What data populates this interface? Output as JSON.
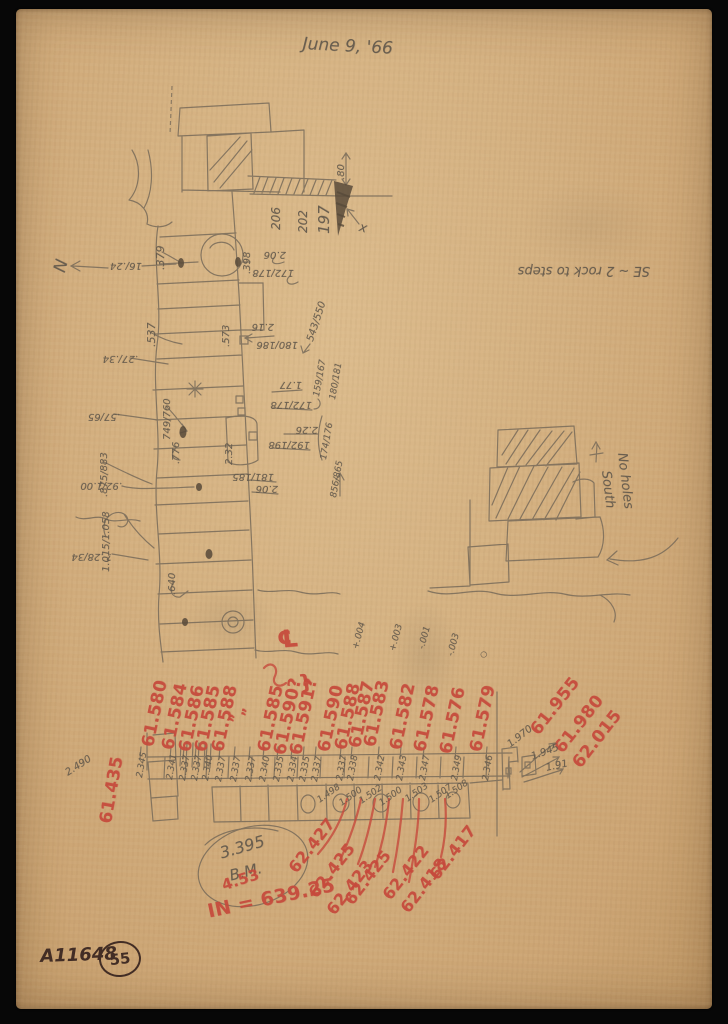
{
  "sheet": {
    "date": "June 9, '66",
    "catalog_number": "A11648",
    "sheet_number": "55"
  },
  "colors": {
    "paper": "#d4b080",
    "pencil": "#63594c",
    "red_crayon": "#c64a3c",
    "ink": "#422d25",
    "background": "#070707"
  },
  "annotations": {
    "plan_measurements": [
      {
        "t": ".379",
        "x": 155,
        "y": 270,
        "r": -90,
        "s": 11
      },
      {
        "t": "16/.24",
        "x": 142,
        "y": 270,
        "r": 180
      },
      {
        "t": ".537",
        "x": 146,
        "y": 347,
        "r": -90,
        "s": 11
      },
      {
        "t": ".27/.34",
        "x": 138,
        "y": 363,
        "r": 180
      },
      {
        "t": ".57/65",
        "x": 120,
        "y": 421,
        "r": 180
      },
      {
        "t": "749/760",
        "x": 163,
        "y": 440,
        "r": -90
      },
      {
        "t": ".776",
        "x": 172,
        "y": 464,
        "r": -90
      },
      {
        "t": ".875/883",
        "x": 100,
        "y": 497,
        "r": -90
      },
      {
        "t": ".92/1.00",
        "x": 122,
        "y": 490,
        "r": 180
      },
      {
        "t": "1.015/1.058",
        "x": 102,
        "y": 572,
        "r": -90
      },
      {
        "t": "? .28/34",
        "x": 112,
        "y": 561,
        "r": 180
      },
      {
        "t": ".640",
        "x": 168,
        "y": 595,
        "r": -90
      },
      {
        "t": ".398",
        "x": 243,
        "y": 274,
        "r": -90
      },
      {
        "t": "2.06",
        "x": 286,
        "y": 259,
        "r": 180
      },
      {
        "t": "172/178",
        "x": 294,
        "y": 277,
        "r": 180
      },
      {
        "t": "2.16",
        "x": 274,
        "y": 331,
        "r": 180
      },
      {
        "t": "180/186",
        "x": 298,
        "y": 349,
        "r": 180
      },
      {
        "t": "543/550",
        "x": 306,
        "y": 340,
        "r": -72
      },
      {
        "t": ".573",
        "x": 222,
        "y": 347,
        "r": -90
      },
      {
        "t": "1.77",
        "x": 302,
        "y": 389,
        "r": 180
      },
      {
        "t": "159/167",
        "x": 313,
        "y": 396,
        "r": -80,
        "s": 9
      },
      {
        "t": "180/181",
        "x": 329,
        "y": 399,
        "r": -80,
        "s": 9
      },
      {
        "t": "172/178",
        "x": 312,
        "y": 409,
        "r": 180
      },
      {
        "t": "174/176",
        "x": 320,
        "y": 459,
        "r": -80,
        "s": 9
      },
      {
        "t": "2.26",
        "x": 318,
        "y": 434,
        "r": 180
      },
      {
        "t": "192/198",
        "x": 310,
        "y": 449,
        "r": 180
      },
      {
        "t": "2.32",
        "x": 225,
        "y": 465,
        "r": -90
      },
      {
        "t": "181/185",
        "x": 274,
        "y": 481,
        "r": 180
      },
      {
        "t": "2.06",
        "x": 278,
        "y": 493,
        "r": 180
      },
      {
        "t": "856/865",
        "x": 330,
        "y": 497,
        "r": -80,
        "s": 9
      },
      {
        "t": "206",
        "x": 270,
        "y": 230,
        "r": -90,
        "s": 12
      },
      {
        "t": "202",
        "x": 297,
        "y": 233,
        "r": -90,
        "s": 12
      },
      {
        "t": "197",
        "x": 317,
        "y": 234,
        "r": -90,
        "s": 15
      },
      {
        "t": ".80",
        "x": 337,
        "y": 180,
        "r": -90
      },
      {
        "t": "x",
        "x": 361,
        "y": 221,
        "r": 15,
        "s": 13,
        "n": "x-mark"
      }
    ],
    "notes": [
      {
        "t": "SE ~ 2 rock to steps",
        "x": 650,
        "y": 277,
        "r": 180,
        "n": "note-rock-to-steps"
      },
      {
        "t": "N",
        "x": 52,
        "y": 270,
        "r": -75,
        "s": 17,
        "n": "north-label"
      },
      {
        "t": "No holes",
        "x": 628,
        "y": 452,
        "r": 83,
        "n": "note-no-holes"
      },
      {
        "t": "South",
        "x": 612,
        "y": 470,
        "r": 83,
        "n": "note-south"
      }
    ],
    "red_elevations": [
      {
        "t": "61.580",
        "x": 140,
        "y": 745
      },
      {
        "t": "61.584",
        "x": 160,
        "y": 748
      },
      {
        "t": "61.586",
        "x": 177,
        "y": 750
      },
      {
        "t": "61.585",
        "x": 193,
        "y": 750
      },
      {
        "t": "61.588",
        "x": 210,
        "y": 750
      },
      {
        "t": "”",
        "x": 228,
        "y": 722,
        "s": 14,
        "n": "ditto-mark"
      },
      {
        "t": "”",
        "x": 240,
        "y": 716,
        "s": 14,
        "n": "ditto-mark"
      },
      {
        "t": "61.585",
        "x": 256,
        "y": 750
      },
      {
        "t": "61.590?",
        "x": 272,
        "y": 753
      },
      {
        "t": "61.591?",
        "x": 288,
        "y": 753
      },
      {
        "t": "}",
        "x": 297,
        "y": 673,
        "r": -10,
        "s": 20,
        "n": "bracket"
      },
      {
        "t": "℄",
        "x": 276,
        "y": 628,
        "r": -5,
        "s": 24,
        "n": "centerline-symbol"
      },
      {
        "t": "61.590",
        "x": 316,
        "y": 750
      },
      {
        "t": "61.588",
        "x": 333,
        "y": 748
      },
      {
        "t": "61.587",
        "x": 347,
        "y": 746
      },
      {
        "t": "61.583",
        "x": 362,
        "y": 745
      },
      {
        "t": "61.582",
        "x": 388,
        "y": 748
      },
      {
        "t": "61.578",
        "x": 412,
        "y": 750
      },
      {
        "t": "61.576",
        "x": 438,
        "y": 752
      },
      {
        "t": "61.579",
        "x": 468,
        "y": 750
      }
    ],
    "pencil_offsets": [
      {
        "t": "2.345",
        "x": 136,
        "y": 777
      },
      {
        "t": "2.341",
        "x": 166,
        "y": 779
      },
      {
        "t": "2.337",
        "x": 179,
        "y": 780
      },
      {
        "t": "2.337",
        "x": 191,
        "y": 780
      },
      {
        "t": "2.340",
        "x": 202,
        "y": 780
      },
      {
        "t": "2.337",
        "x": 215,
        "y": 781
      },
      {
        "t": "2.337",
        "x": 230,
        "y": 781
      },
      {
        "t": "2.337",
        "x": 245,
        "y": 781
      },
      {
        "t": "2.340",
        "x": 259,
        "y": 781
      },
      {
        "t": "2.335",
        "x": 273,
        "y": 781
      },
      {
        "t": "2.334",
        "x": 287,
        "y": 781
      },
      {
        "t": "2.335",
        "x": 299,
        "y": 781
      },
      {
        "t": "2.337",
        "x": 311,
        "y": 781
      },
      {
        "t": "2.337",
        "x": 336,
        "y": 780
      },
      {
        "t": "2.338",
        "x": 347,
        "y": 780
      },
      {
        "t": "2.342",
        "x": 374,
        "y": 780
      },
      {
        "t": "2.343",
        "x": 396,
        "y": 780
      },
      {
        "t": "2.347",
        "x": 419,
        "y": 780
      },
      {
        "t": "2.349",
        "x": 451,
        "y": 780
      },
      {
        "t": "2.346",
        "x": 482,
        "y": 780
      }
    ],
    "level_deltas": [
      {
        "t": "+.004",
        "x": 352,
        "y": 648
      },
      {
        "t": "+.003",
        "x": 389,
        "y": 650
      },
      {
        "t": "-.001",
        "x": 418,
        "y": 648
      },
      {
        "t": "-.003",
        "x": 447,
        "y": 655
      },
      {
        "t": "○",
        "x": 479,
        "y": 657,
        "s": 8,
        "n": "small-circle-mark"
      }
    ],
    "course_heights": [
      {
        "t": "1.498",
        "x": 316,
        "y": 798
      },
      {
        "t": "1.500",
        "x": 338,
        "y": 801
      },
      {
        "t": "1.502",
        "x": 358,
        "y": 799
      },
      {
        "t": "1.500",
        "x": 378,
        "y": 801
      },
      {
        "t": "1.503",
        "x": 404,
        "y": 797
      },
      {
        "t": "1.507",
        "x": 428,
        "y": 798
      },
      {
        "t": "1.508",
        "x": 444,
        "y": 794
      }
    ],
    "red_bottom_elevations": [
      {
        "t": "62.427",
        "x": 286,
        "y": 866
      },
      {
        "t": "62.425",
        "x": 306,
        "y": 891
      },
      {
        "t": "62.423",
        "x": 324,
        "y": 908
      },
      {
        "t": "62.425",
        "x": 342,
        "y": 898
      },
      {
        "t": "62.422",
        "x": 380,
        "y": 893
      },
      {
        "t": "62.418",
        "x": 398,
        "y": 906
      },
      {
        "t": "62.417",
        "x": 427,
        "y": 873
      }
    ],
    "red_right_elevations": [
      {
        "t": "61.955",
        "x": 528,
        "y": 728
      },
      {
        "t": "61.980",
        "x": 552,
        "y": 746
      },
      {
        "t": "62.015",
        "x": 570,
        "y": 761
      }
    ],
    "pencil_right_measurements": [
      {
        "t": "1.970",
        "x": 506,
        "y": 742,
        "r": -38
      },
      {
        "t": "1.945",
        "x": 530,
        "y": 753,
        "r": -20
      },
      {
        "t": "1.91",
        "x": 545,
        "y": 764,
        "r": -12
      }
    ],
    "left_marks": [
      {
        "t": "61.435",
        "x": 98,
        "y": 822,
        "r": -80,
        "s": 17,
        "c": "red",
        "n": "elevation-label"
      },
      {
        "t": "2.490",
        "x": 64,
        "y": 770,
        "r": -33,
        "s": 10,
        "c": "pencil",
        "n": "measurement-label"
      }
    ],
    "benchmark": [
      {
        "t": "3.395",
        "x": 218,
        "y": 846,
        "r": -16,
        "s": 16,
        "n": "benchmark-value"
      },
      {
        "t": "B.M.",
        "x": 228,
        "y": 869,
        "r": -14,
        "s": 15,
        "n": "benchmark-label"
      }
    ],
    "datum": [
      {
        "t": "4.53",
        "x": 220,
        "y": 879,
        "r": -18,
        "s": 15
      },
      {
        "t": "IN = 639.25",
        "x": 206,
        "y": 903,
        "r": -12,
        "s": 19
      }
    ]
  }
}
